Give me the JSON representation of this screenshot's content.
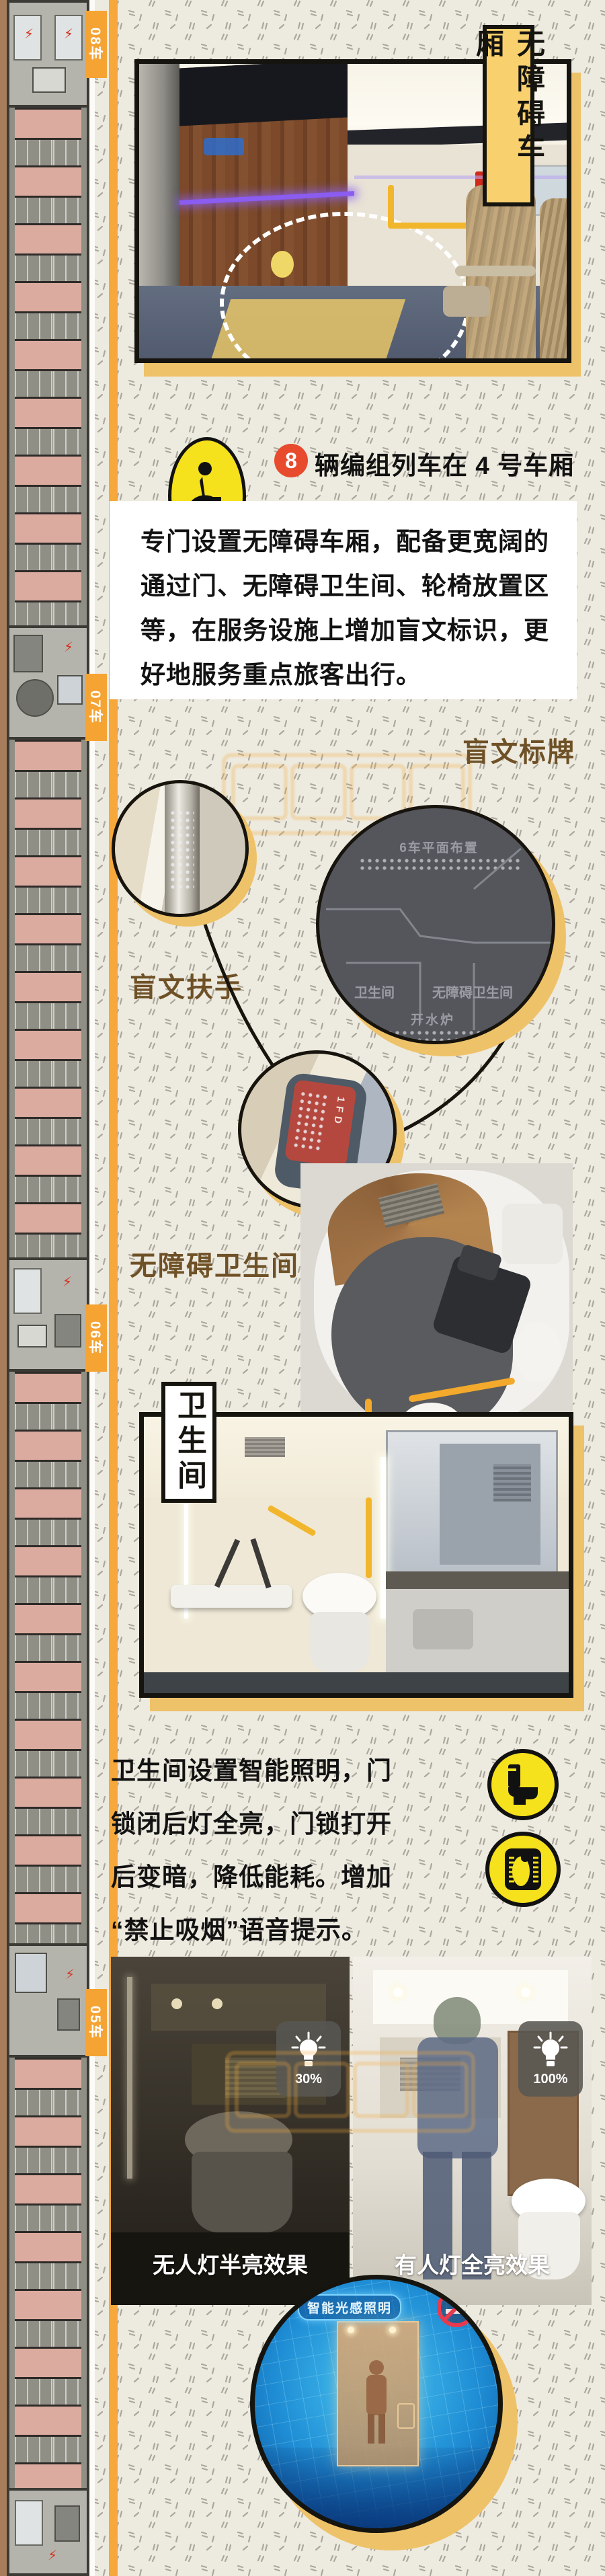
{
  "header": {
    "title": "无障碍车厢"
  },
  "sidebar": {
    "cars": [
      {
        "label": "08车"
      },
      {
        "label": "07车"
      },
      {
        "label": "06车"
      },
      {
        "label": "05车"
      }
    ]
  },
  "wheelchair_info": {
    "line1": {
      "badge": "8",
      "text": "辆编组列车在 4 号车厢"
    },
    "line2": {
      "badge": "17",
      "text": "辆编组列车在 8 号车厢"
    }
  },
  "intro": {
    "lines": [
      "专门设置无障碍车厢，配备更宽阔的",
      "通过门、无障碍卫生间、轮椅放置区",
      "等，在服务设施上增加盲文标识，更",
      "好地服务重点旅客出行。"
    ]
  },
  "braille": {
    "sign_label": "盲文标牌",
    "handrail_label": "盲文扶手",
    "seat_handle_label": "座椅盲文把手",
    "sign": {
      "title": "6车平面布置",
      "left": "卫生间",
      "right": "无障碍卫生间",
      "bottom": "开水炉"
    },
    "handle_text": "1FD"
  },
  "accessible_toilet": {
    "label": "无障碍卫生间"
  },
  "toilet": {
    "title": "卫生间",
    "lines": [
      "卫生间设置智能照明，门",
      "锁闭后灯全亮，门锁打开",
      "后变暗，降低能耗。增加",
      "“禁止吸烟”语音提示。"
    ]
  },
  "lighting": {
    "left_caption": "无人灯半亮效果",
    "right_caption": "有人灯全亮效果",
    "left_level": "30%",
    "right_level": "100%",
    "smart_label": "智能光感照明"
  },
  "colors": {
    "accent_orange": "#f6a83b",
    "banner_yellow": "#f8d06e",
    "shadow_yellow": "#eec269",
    "badge_red": "#e84a2e",
    "icon_yellow": "#f5e11c"
  }
}
